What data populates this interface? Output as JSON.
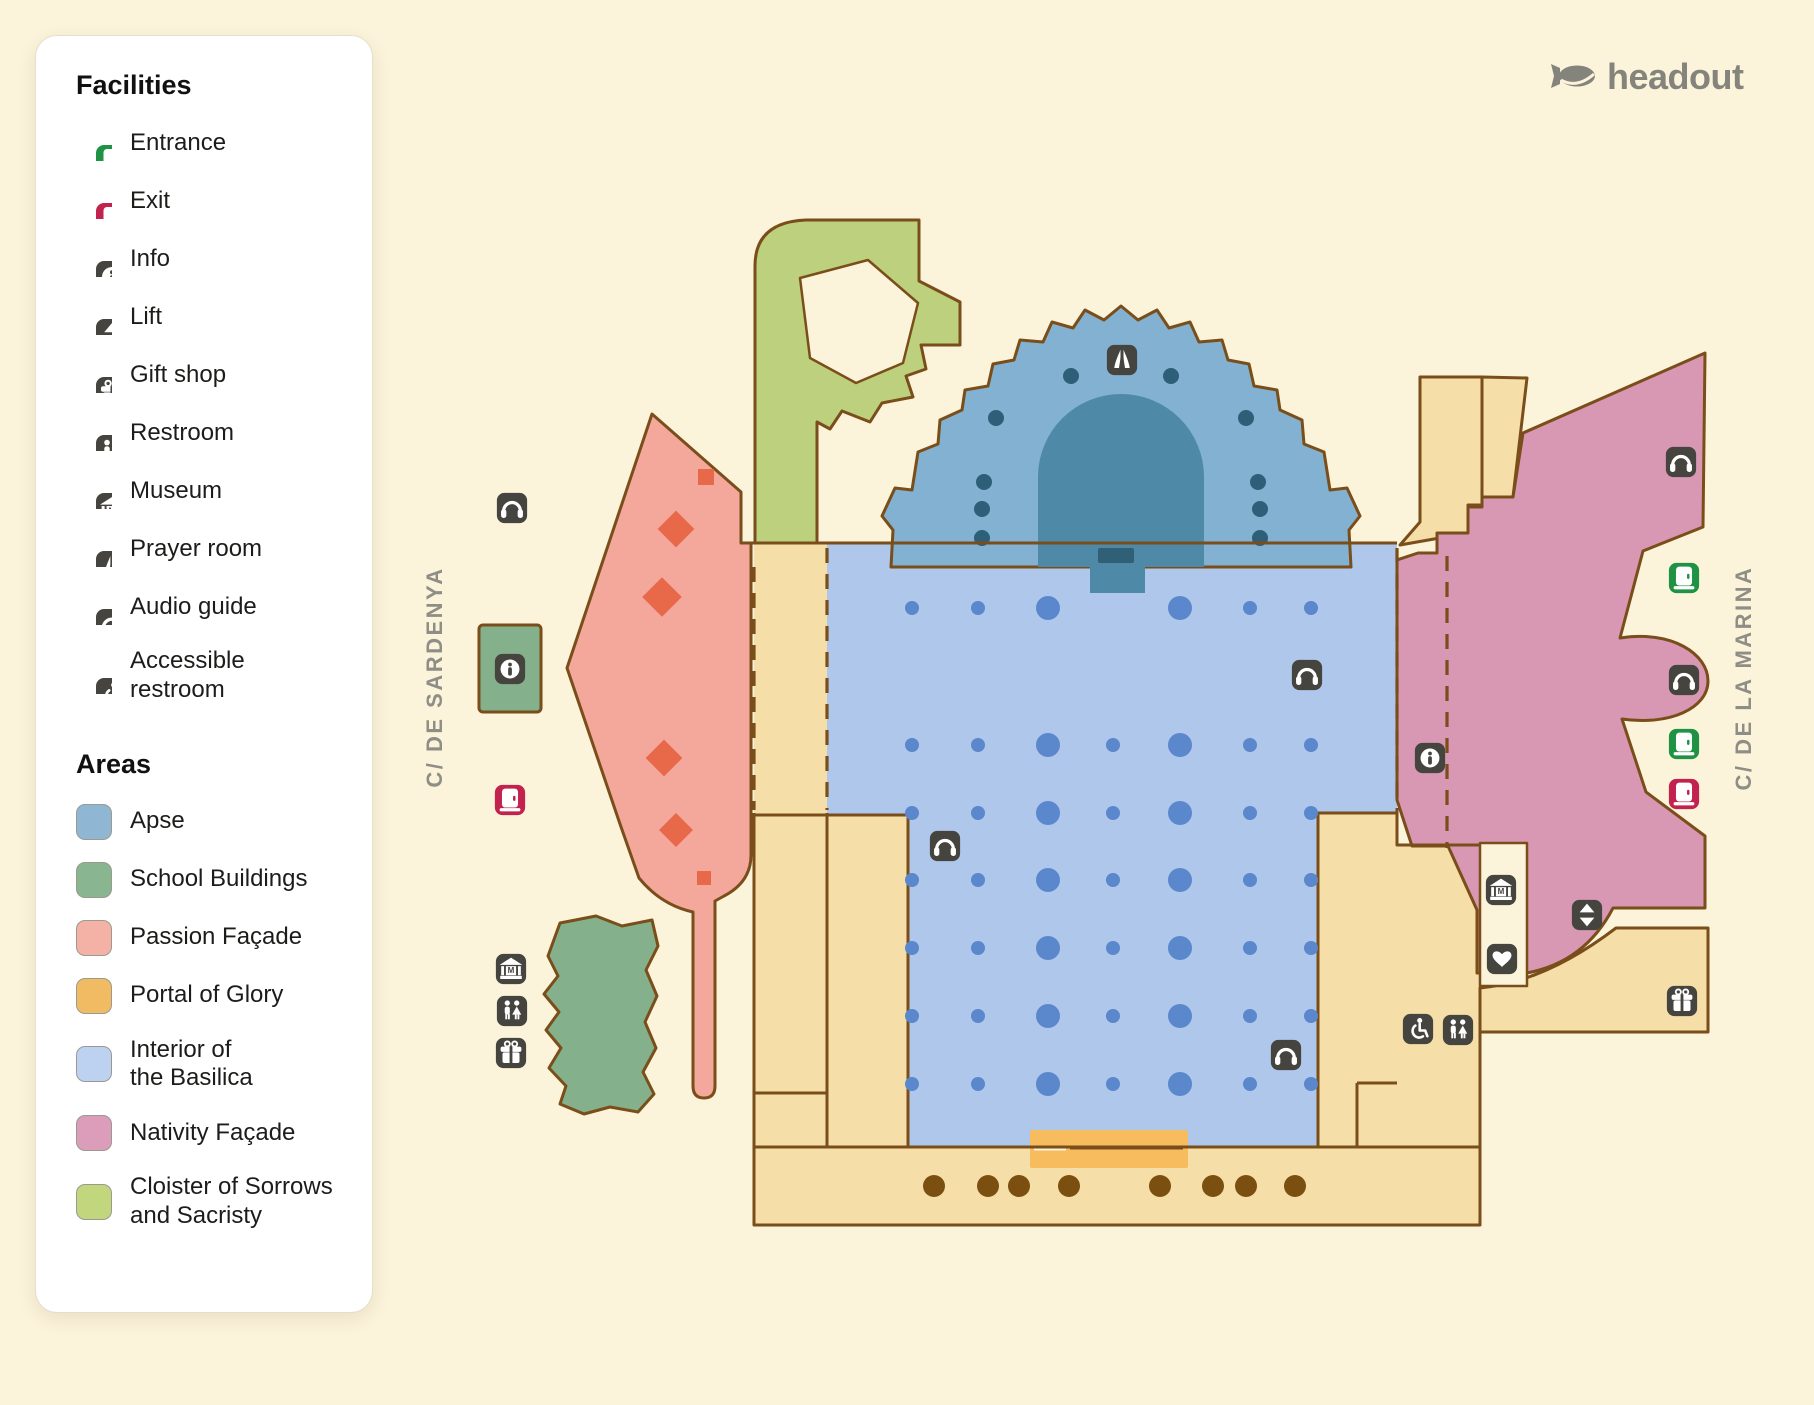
{
  "brand": {
    "name": "headout"
  },
  "legend": {
    "facilities_title": "Facilities",
    "areas_title": "Areas",
    "facilities": [
      {
        "icon": "door-green",
        "label": "Entrance"
      },
      {
        "icon": "door-red",
        "label": "Exit"
      },
      {
        "icon": "info",
        "label": "Info"
      },
      {
        "icon": "lift",
        "label": "Lift"
      },
      {
        "icon": "gift",
        "label": "Gift shop"
      },
      {
        "icon": "restroom",
        "label": "Restroom"
      },
      {
        "icon": "museum",
        "label": "Museum"
      },
      {
        "icon": "prayer",
        "label": "Prayer room"
      },
      {
        "icon": "audio",
        "label": "Audio guide"
      },
      {
        "icon": "wheelchair",
        "label": "Accessible\nrestroom"
      }
    ],
    "areas": [
      {
        "key": "apse",
        "label": "Apse",
        "color": "#8FB6D3"
      },
      {
        "key": "school",
        "label": "School Buildings",
        "color": "#8AB591"
      },
      {
        "key": "passion",
        "label": "Passion Façade",
        "color": "#F4B1A5"
      },
      {
        "key": "portal",
        "label": "Portal of Glory",
        "color": "#F0BB62"
      },
      {
        "key": "interior",
        "label": "Interior of\nthe Basilica",
        "color": "#BDD2F0"
      },
      {
        "key": "nativity",
        "label": "Nativity Façade",
        "color": "#DB9DBA"
      },
      {
        "key": "cloister",
        "label": "Cloister of Sorrows\nand Sacristy",
        "color": "#C2D67E"
      }
    ]
  },
  "map": {
    "streets": [
      {
        "label": "C/ DE SARDENYA"
      },
      {
        "label": "C/ DE LA MARINA"
      }
    ],
    "markers": [
      {
        "t": "prayer",
        "x": 1122,
        "y": 360
      },
      {
        "t": "audio",
        "x": 512,
        "y": 508
      },
      {
        "t": "info",
        "x": 510,
        "y": 669
      },
      {
        "t": "door-red",
        "x": 510,
        "y": 800
      },
      {
        "t": "museum",
        "x": 511,
        "y": 969
      },
      {
        "t": "restroom",
        "x": 512,
        "y": 1011
      },
      {
        "t": "gift",
        "x": 511,
        "y": 1053
      },
      {
        "t": "audio",
        "x": 945,
        "y": 846
      },
      {
        "t": "audio",
        "x": 1307,
        "y": 675
      },
      {
        "t": "info",
        "x": 1430,
        "y": 758
      },
      {
        "t": "audio",
        "x": 1681,
        "y": 462
      },
      {
        "t": "door-green",
        "x": 1684,
        "y": 578
      },
      {
        "t": "audio",
        "x": 1684,
        "y": 680
      },
      {
        "t": "door-green",
        "x": 1684,
        "y": 744
      },
      {
        "t": "door-red",
        "x": 1684,
        "y": 794
      },
      {
        "t": "museum",
        "x": 1501,
        "y": 890
      },
      {
        "t": "lift",
        "x": 1587,
        "y": 915
      },
      {
        "t": "heart",
        "x": 1502,
        "y": 959
      },
      {
        "t": "wheelchair",
        "x": 1418,
        "y": 1029
      },
      {
        "t": "restroom",
        "x": 1458,
        "y": 1030
      },
      {
        "t": "gift",
        "x": 1682,
        "y": 1001
      },
      {
        "t": "audio",
        "x": 1286,
        "y": 1055
      }
    ],
    "interior_dot_grid": {
      "cols": [
        912,
        978,
        1048,
        1113,
        1180,
        1250,
        1311
      ],
      "col_r": [
        7,
        7,
        12,
        7,
        12,
        7,
        7
      ],
      "rows": [
        608,
        745,
        813,
        880,
        948,
        1016,
        1084
      ],
      "skip": [
        [
          0,
          3
        ]
      ]
    },
    "apse_dots": [
      [
        1071,
        376
      ],
      [
        1171,
        376
      ],
      [
        996,
        418
      ],
      [
        1246,
        418
      ],
      [
        984,
        482
      ],
      [
        1258,
        482
      ],
      [
        982,
        509
      ],
      [
        1260,
        509
      ],
      [
        982,
        538
      ],
      [
        1260,
        538
      ]
    ],
    "portal_dots": {
      "xs": [
        934,
        988,
        1019,
        1069,
        1160,
        1213,
        1246,
        1295
      ],
      "y": 1186,
      "r": 11
    },
    "passion_diamonds": [
      {
        "x": 706,
        "y": 477,
        "s": 16,
        "rot": 0
      },
      {
        "x": 676,
        "y": 529,
        "s": 26,
        "rot": 45
      },
      {
        "x": 662,
        "y": 597,
        "s": 28,
        "rot": 45
      },
      {
        "x": 664,
        "y": 758,
        "s": 26,
        "rot": 45
      },
      {
        "x": 676,
        "y": 830,
        "s": 24,
        "rot": 45
      },
      {
        "x": 704,
        "y": 878,
        "s": 14,
        "rot": 0
      }
    ]
  },
  "colors": {
    "page_bg": "#FBF3DA",
    "outline": "#7A4E1A",
    "tan": "#F5DEA7",
    "interior": "#AFC7EA",
    "interior_dot": "#5B87CC",
    "apse": "#82B1D1",
    "apse_dome": "#4E89A8",
    "apse_dome_dark": "#2F6076",
    "apse_dot": "#2D5F78",
    "school": "#84B18B",
    "cloister": "#BDD07E",
    "passion": "#F4A89C",
    "diamond": "#E8684A",
    "portal": "#F6BC5D",
    "nativity": "#D897B3",
    "brown_dot": "#7B4F10",
    "icon_dark": "#45443F",
    "icon_green": "#1F9243",
    "icon_red": "#C2224E",
    "street_text": "#8E8E86",
    "brand_text": "#84847C",
    "legend_bg": "#FFFFFF",
    "legend_text": "#1C1C1A"
  }
}
